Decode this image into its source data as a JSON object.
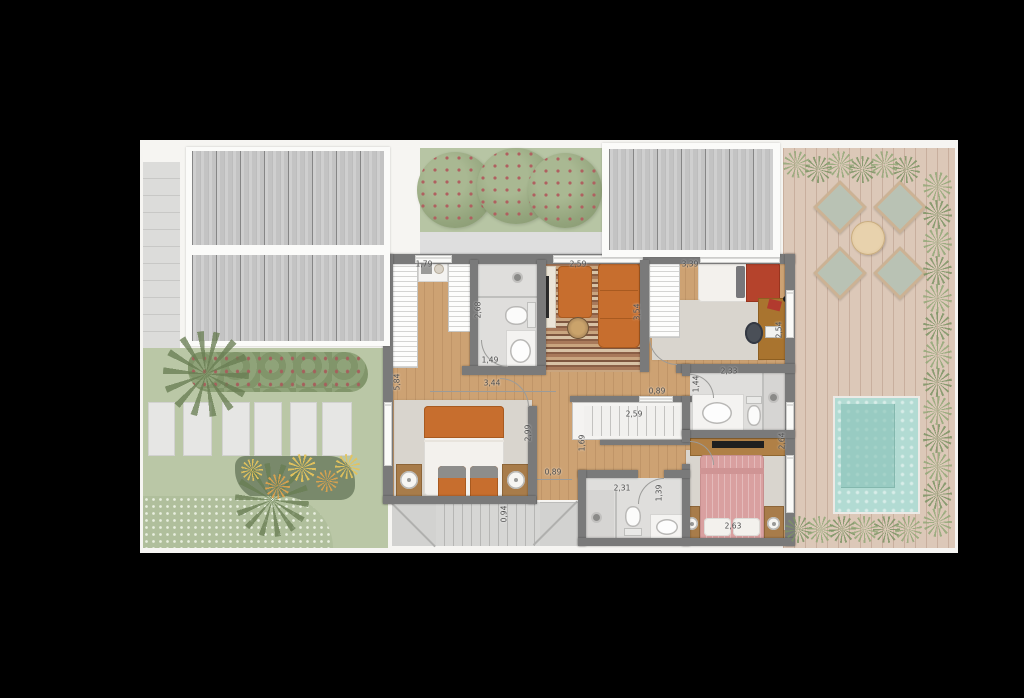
{
  "plan_type": "floor-plan-top-view",
  "palette": {
    "background": "#000000",
    "wall": "#7a7a7a",
    "wood_floor": "#cda273",
    "deck_wood": "#dcc8b8",
    "pool_water": "#b2dbd3",
    "lawn": "#bac7a6",
    "accent_orange": "#c76e2e",
    "accent_pink": "#d9a0a0",
    "roof_metal": "#c6c6c6",
    "label_text": "#4c4c4c"
  },
  "glyphs": {
    "plant_icon": "conic-burst",
    "flower_icon": "conic-burst-orange"
  },
  "dimension_labels": [
    {
      "text": "1,79",
      "x": 424,
      "y": 264,
      "rot": 0
    },
    {
      "text": "2,68",
      "x": 478,
      "y": 310,
      "rot": 90
    },
    {
      "text": "1,49",
      "x": 490,
      "y": 360,
      "rot": 0
    },
    {
      "text": "3,44",
      "x": 492,
      "y": 383,
      "rot": 0
    },
    {
      "text": "5,84",
      "x": 397,
      "y": 382,
      "rot": 90
    },
    {
      "text": "2,59",
      "x": 578,
      "y": 264,
      "rot": 0
    },
    {
      "text": "3,54",
      "x": 637,
      "y": 312,
      "rot": 90
    },
    {
      "text": "3,39",
      "x": 690,
      "y": 264,
      "rot": 0
    },
    {
      "text": "2,54",
      "x": 779,
      "y": 330,
      "rot": 90
    },
    {
      "text": "2,33",
      "x": 729,
      "y": 371,
      "rot": 0
    },
    {
      "text": "1,44",
      "x": 696,
      "y": 384,
      "rot": 90
    },
    {
      "text": "0,89",
      "x": 657,
      "y": 391,
      "rot": 0
    },
    {
      "text": "2,99",
      "x": 528,
      "y": 433,
      "rot": 90
    },
    {
      "text": "0,89",
      "x": 553,
      "y": 472,
      "rot": 0
    },
    {
      "text": "2,59",
      "x": 634,
      "y": 414,
      "rot": 0
    },
    {
      "text": "1,69",
      "x": 582,
      "y": 443,
      "rot": 90
    },
    {
      "text": "2,31",
      "x": 622,
      "y": 488,
      "rot": 0
    },
    {
      "text": "1,39",
      "x": 659,
      "y": 493,
      "rot": 90
    },
    {
      "text": "2,63",
      "x": 733,
      "y": 526,
      "rot": 0
    },
    {
      "text": "2,64",
      "x": 782,
      "y": 441,
      "rot": 90
    },
    {
      "text": "0,94",
      "x": 504,
      "y": 514,
      "rot": 90
    }
  ]
}
